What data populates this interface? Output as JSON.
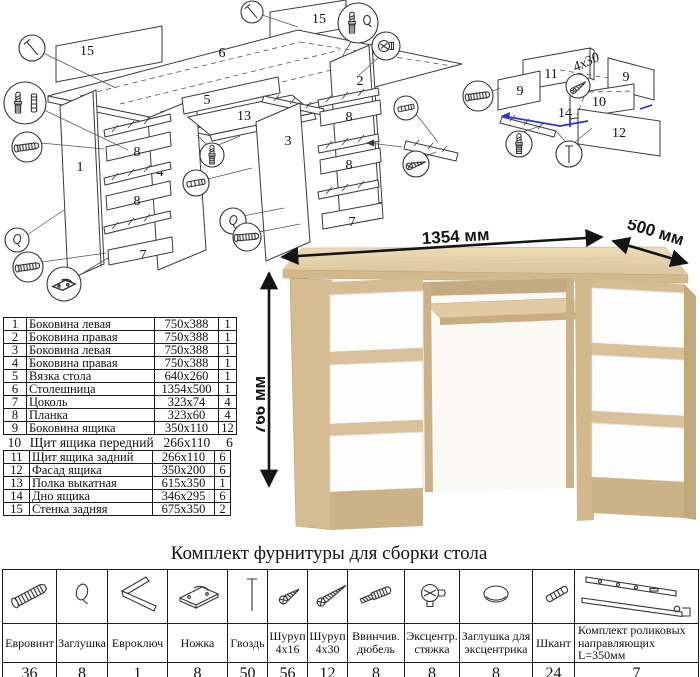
{
  "assembly_diagram": {
    "part_labels": {
      "back_wall_left": "15",
      "tabletop": "6",
      "back_wall_right": "15",
      "tie": "5",
      "pullout_shelf": "13",
      "side_1": "1",
      "plank_8a": "8",
      "side_4": "4",
      "plank_8b": "8",
      "plinth_left": "7",
      "side_3": "3",
      "side_2": "2",
      "plank_8c": "8",
      "plank_8d": "8",
      "plinth_right": "7",
      "drawer_back": "11",
      "drawer_side_left": "9",
      "drawer_side_right": "9",
      "drawer_front_shield": "10",
      "drawer_facade": "12",
      "drawer_bottom": "14",
      "screw_size_note": "4x30"
    }
  },
  "parts_table": {
    "rows": [
      {
        "num": "1",
        "name": "Боковина левая",
        "size": "750x388",
        "qty": "1"
      },
      {
        "num": "2",
        "name": "Боковина правая",
        "size": "750x388",
        "qty": "1"
      },
      {
        "num": "3",
        "name": "Боковина левая",
        "size": "750x388",
        "qty": "1"
      },
      {
        "num": "4",
        "name": "Боковина правая",
        "size": "750x388",
        "qty": "1"
      },
      {
        "num": "5",
        "name": "Вязка стола",
        "size": "640x260",
        "qty": "1"
      },
      {
        "num": "6",
        "name": "Столешница",
        "size": "1354x500",
        "qty": "1"
      },
      {
        "num": "7",
        "name": "Цоколь",
        "size": "323x74",
        "qty": "4"
      },
      {
        "num": "8",
        "name": "Планка",
        "size": "323x60",
        "qty": "4"
      },
      {
        "num": "9",
        "name": "Боковина ящика",
        "size": "350x110",
        "qty": "12"
      },
      {
        "num": "10",
        "name": "Щит ящика передний",
        "size": "266x110",
        "qty": "6"
      },
      {
        "num": "11",
        "name": "Щит ящика задний",
        "size": "266x110",
        "qty": "6"
      },
      {
        "num": "12",
        "name": "Фасад ящика",
        "size": "350x200",
        "qty": "6"
      },
      {
        "num": "13",
        "name": "Полка выкатная",
        "size": "615x350",
        "qty": "1"
      },
      {
        "num": "14",
        "name": "Дно ящика",
        "size": "346x295",
        "qty": "6"
      },
      {
        "num": "15",
        "name": "Стенка задняя",
        "size": "675x350",
        "qty": "2"
      }
    ]
  },
  "desk_render": {
    "width_label": "1354 мм",
    "depth_label": "500 мм",
    "height_label": "766 мм",
    "colors": {
      "oak": "#d6bc92",
      "oak_top": "#e7d6b1",
      "oak_dark": "#c2a87d",
      "drawer_white": "#fdfdfd"
    }
  },
  "hardware_table": {
    "title": "Комплект фурнитуры для сборки стола",
    "items": [
      {
        "name": "Евровинт",
        "qty": "36",
        "icon": "euro-screw"
      },
      {
        "name": "Заглушка",
        "qty": "8",
        "icon": "cap"
      },
      {
        "name": "Евроключ",
        "qty": "1",
        "icon": "hex-key"
      },
      {
        "name": "Ножка",
        "qty": "8",
        "icon": "foot"
      },
      {
        "name": "Гвоздь",
        "qty": "50",
        "icon": "nail"
      },
      {
        "name": "Шуруп 4x16",
        "qty": "56",
        "icon": "screw-short"
      },
      {
        "name": "Шуруп 4x30",
        "qty": "12",
        "icon": "screw-long"
      },
      {
        "name": "Ввинчив. дюбель",
        "qty": "8",
        "icon": "screw-in-dowel"
      },
      {
        "name": "Эксцентр. стяжка",
        "qty": "8",
        "icon": "cam-lock"
      },
      {
        "name": "Заглушка для эксцентрика",
        "qty": "8",
        "icon": "cam-cap"
      },
      {
        "name": "Шкант",
        "qty": "24",
        "icon": "wood-dowel"
      },
      {
        "name": "Комплект роликовых направляющих L=350мм",
        "qty": "7",
        "icon": "roller-slide"
      }
    ]
  }
}
